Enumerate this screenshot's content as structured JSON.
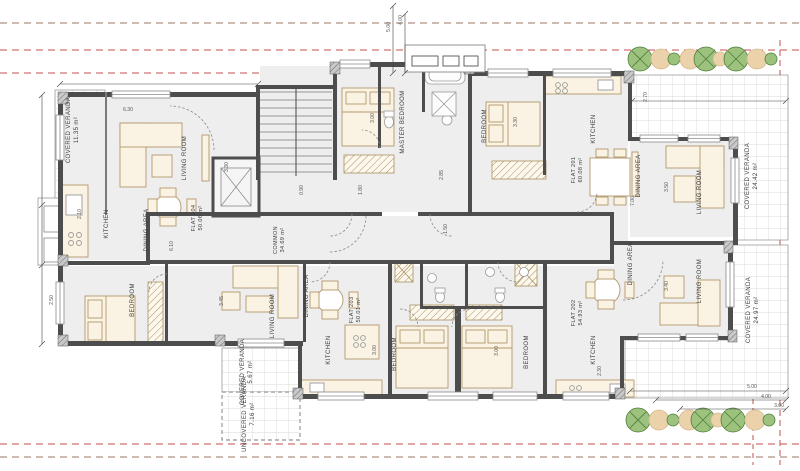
{
  "drawing": {
    "type": "architectural floor plan",
    "description": "Apartment floor with flats 201-204, common core, verandas and planting"
  },
  "room_labels": {
    "living_room": "LIVING ROOM",
    "kitchen": "KITCHEN",
    "dining_area": "DINING AREA",
    "bedroom": "BEDROOM",
    "master_bedroom": "MASTER BEDROOM"
  },
  "common": {
    "name": "COMMON",
    "area": "34.69 m²"
  },
  "flats": {
    "f201": {
      "name": "FLAT 201",
      "area": "60.08 m²"
    },
    "f202": {
      "name": "FLAT 202",
      "area": "54.93 m²"
    },
    "f203": {
      "name": "FLAT 203",
      "area": "50.01 m²"
    },
    "f204": {
      "name": "FLAT 204",
      "area": "50.06 m²"
    }
  },
  "verandas": {
    "top_left": {
      "name": "COVERED VERANDA",
      "area": "11.35 m²"
    },
    "right": {
      "name": "COVERED VERANDA",
      "area": "24.42 m²"
    },
    "bottom_right": {
      "name": "COVERED VERANDA",
      "area": "24.97 m²"
    },
    "bottom_left_covered": {
      "name": "COVERED VERANDA",
      "area": "5.67 m²"
    },
    "bottom_left_uncovered": {
      "name": "UNCOVERED VERANDA",
      "area": "7.16 m²"
    }
  },
  "dimensions": [
    "5.00",
    "4.00",
    "2.70",
    "5.00",
    "4.00",
    "3.00",
    "6.30",
    "3.30",
    "3.00",
    "2.85",
    "3.30",
    "3.45",
    "1.50",
    "3.50",
    "7.00",
    "2.30",
    "3.00",
    "3.00",
    "6.10",
    "2.50",
    "2.10",
    "1.80",
    "3.40",
    "0.90"
  ],
  "colors": {
    "wall": "#4d4d4d",
    "floor": "#eeeeee",
    "boundary_red": "#c0504d",
    "boundary_brown": "#a2766a",
    "furniture": "#b3976b",
    "tree_green": "#9cc27e",
    "tree_tan": "#ecd2ab",
    "tile_line": "#d0cdc8"
  }
}
